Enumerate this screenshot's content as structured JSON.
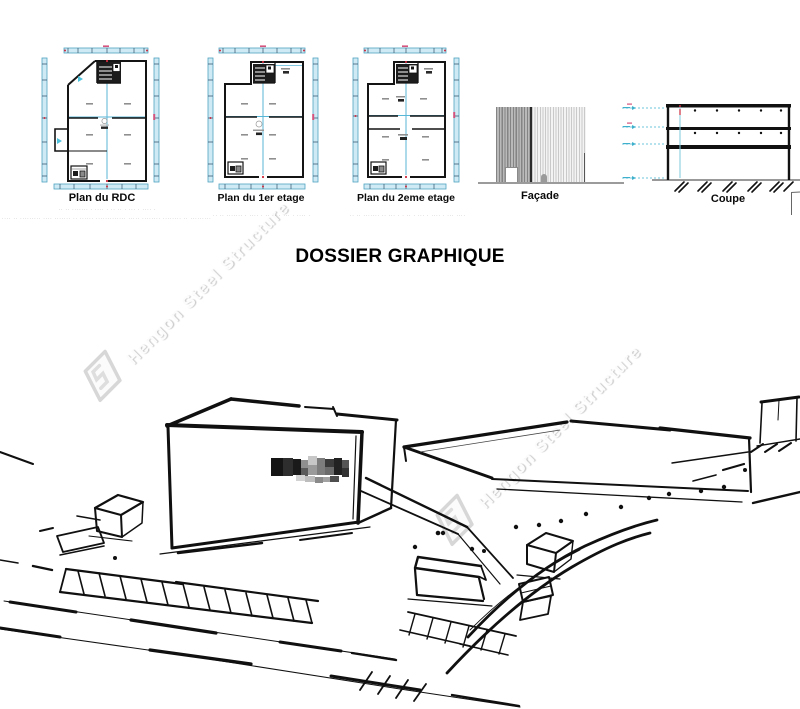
{
  "document": {
    "title": "DOSSIER GRAPHIQUE",
    "plans": [
      {
        "caption": "Plan du RDC",
        "fineprint_1": "·· ·· ·······  · ···· ·  ·· ·· · ··· · ···· ·",
        "fineprint_2": "···· ·· ········· ···· ······· ·· ······ ············· ····· ········ ········ ·· ········· ··· ···· ··········· ·········"
      },
      {
        "caption": "Plan du 1er etage",
        "fineprint_1": "·· ·· ·······  · ···· ·  ·· ·· · ··· · ···· ·"
      },
      {
        "caption": "Plan du 2eme etage",
        "fineprint_1": "·· ·· ·······  ·· ··· ·  · ·· · ··· · ···· · ··· ······· ·"
      }
    ],
    "elevations": [
      {
        "caption": "Façade"
      },
      {
        "caption": "Coupe"
      }
    ]
  },
  "watermark": {
    "text": "Hengon Steel Structure"
  },
  "colors": {
    "dimension_band": "#cfeaf5",
    "dimension_band_border": "#4fa3c0",
    "axis_cyan": "#58b6d6",
    "tick_red": "#cc2a3d",
    "tick_magenta": "#d4547e",
    "wall_black": "#141414",
    "sketch_ink": "#101010"
  }
}
